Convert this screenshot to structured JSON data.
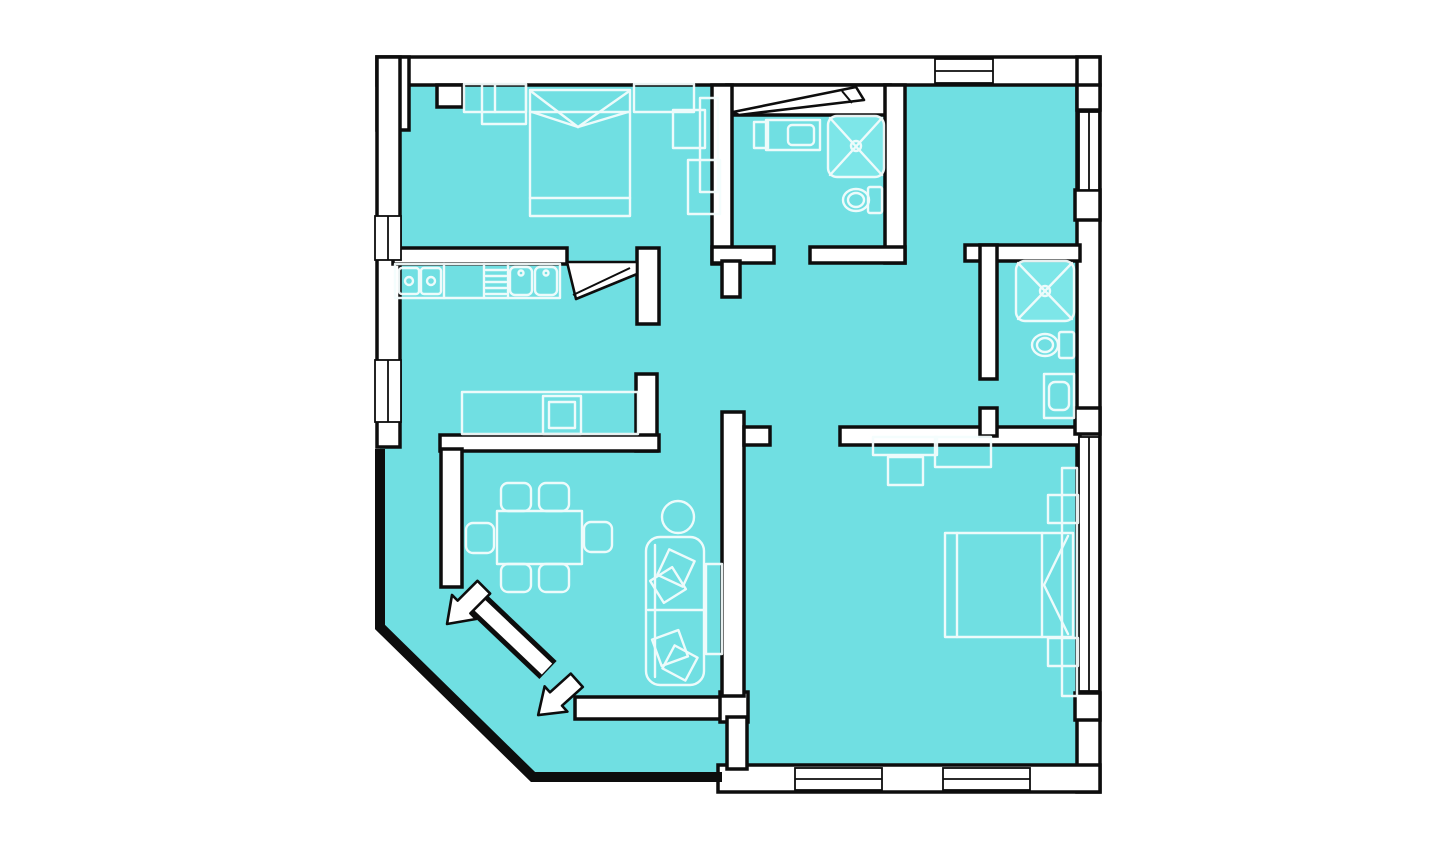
{
  "colors": {
    "background": "#ffffff",
    "floor": "#70dfe2",
    "wall": "#ffffff",
    "outline": "#0d0d0d",
    "furniture_line": "#f4fdfd",
    "fixture_fill": "#7ee7e9"
  },
  "plan": {
    "type": "apartment-floor-plan",
    "rooms": [
      "bedroom-top-left",
      "bathroom-top",
      "entry-hall-top-right",
      "bathroom-right",
      "kitchen",
      "living-dining-room",
      "bedroom-bottom-right",
      "balcony-bottom-left",
      "central-hallway"
    ],
    "fixtures": [
      "double-bed",
      "wardrobe-shelves",
      "nightstand",
      "stove-4-burner",
      "counter-drainboard",
      "double-sink",
      "lower-cabinet-row",
      "dining-table",
      "six-chairs",
      "round-side-table",
      "sofa-with-cushions",
      "tv-stand",
      "shower-tray",
      "toilet",
      "washbasin",
      "double-bed-2",
      "nightstand-top",
      "nightstand-bottom",
      "wardrobe-tall"
    ],
    "door_markers": [
      "kitchen-door-leaf",
      "vent-window-flap",
      "balcony-door-arrow-upper",
      "balcony-door-arrow-lower"
    ],
    "window_openings": [
      "left-wall-window-a",
      "left-wall-window-b",
      "top-wall-entry-window",
      "right-wall-window-a",
      "right-wall-window-b",
      "bottom-wall-window-a",
      "bottom-wall-window-b"
    ]
  }
}
